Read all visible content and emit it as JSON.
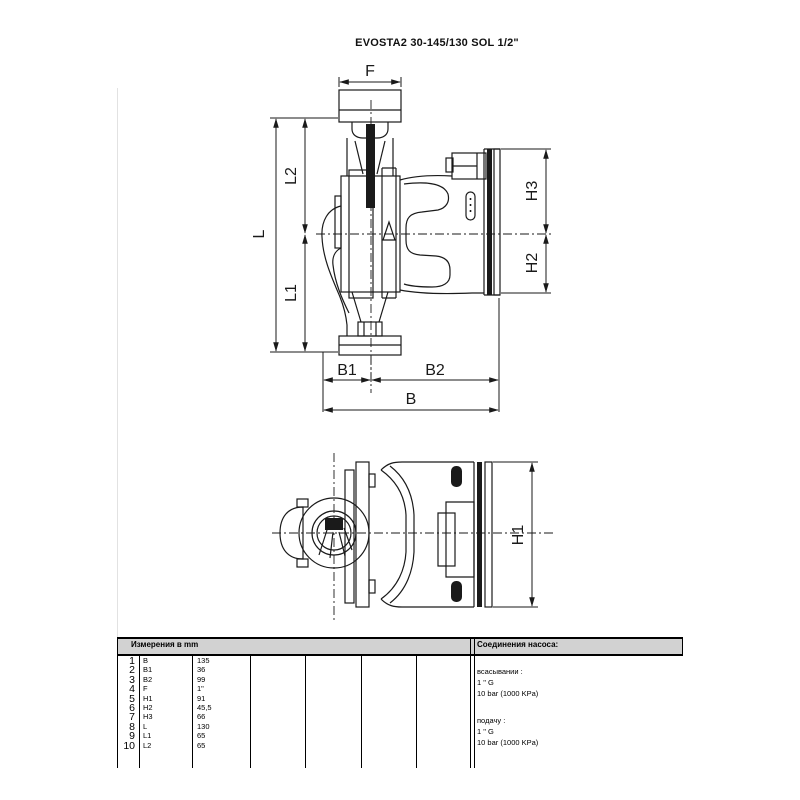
{
  "page": {
    "title": "EVOSTA2 30-145/130 SOL 1/2\""
  },
  "drawing": {
    "dim_labels": {
      "f": "F",
      "l2": "L2",
      "l": "L",
      "l1": "L1",
      "h3": "H3",
      "h2": "H2",
      "b1": "B1",
      "b2": "B2",
      "b": "B",
      "h1": "H1"
    }
  },
  "table": {
    "dimensions_header": "Измерения в  mm",
    "connections_header": "Соединения насоса:",
    "rows": [
      {
        "num": "1",
        "label": "B",
        "value": "135"
      },
      {
        "num": "2",
        "label": "B1",
        "value": "36"
      },
      {
        "num": "3",
        "label": "B2",
        "value": "99"
      },
      {
        "num": "4",
        "label": "F",
        "value": "1\""
      },
      {
        "num": "5",
        "label": "H1",
        "value": "91"
      },
      {
        "num": "6",
        "label": "H2",
        "value": "45,5"
      },
      {
        "num": "7",
        "label": "H3",
        "value": "66"
      },
      {
        "num": "8",
        "label": "L",
        "value": "130"
      },
      {
        "num": "9",
        "label": "L1",
        "value": "65"
      },
      {
        "num": "10",
        "label": "L2",
        "value": "65"
      }
    ],
    "connections": {
      "suction_label": "всасывании :",
      "suction_size": "1 \" G",
      "suction_pressure": "10 bar (1000 KPa)",
      "discharge_label": "подачу :",
      "discharge_size": "1 \" G",
      "discharge_pressure": "10 bar (1000 KPa)"
    }
  },
  "colors": {
    "line": "#1a1a1a",
    "table_header_bg": "#d2d2d2"
  }
}
